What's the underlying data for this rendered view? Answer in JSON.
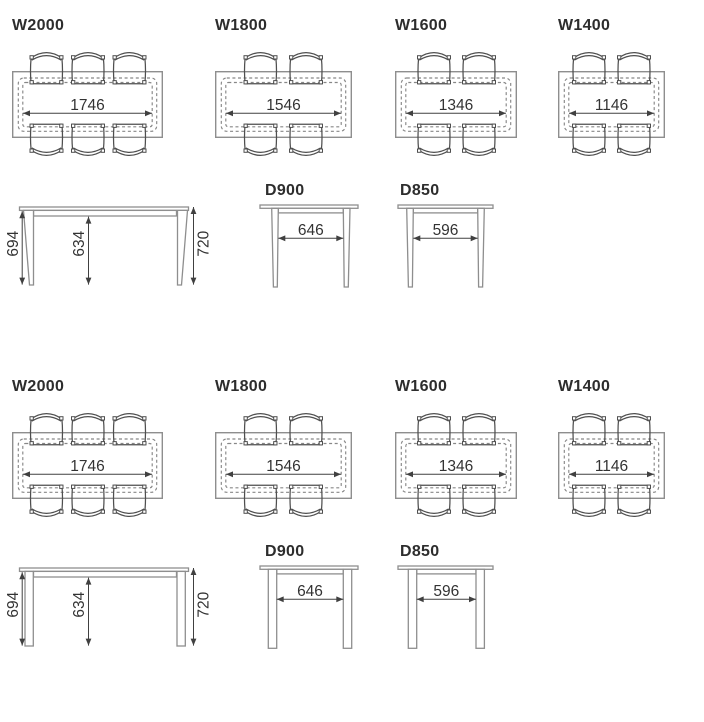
{
  "sections": [
    {
      "leg_style": "tapered",
      "top_views": [
        {
          "label": "W2000",
          "dim": "1746"
        },
        {
          "label": "W1800",
          "dim": "1546"
        },
        {
          "label": "W1600",
          "dim": "1346"
        },
        {
          "label": "W1400",
          "dim": "1146"
        }
      ],
      "side_view": {
        "left": "694",
        "middle": "634",
        "right": "720"
      },
      "end_views": [
        {
          "label": "D900",
          "dim": "646"
        },
        {
          "label": "D850",
          "dim": "596"
        }
      ]
    },
    {
      "leg_style": "straight",
      "top_views": [
        {
          "label": "W2000",
          "dim": "1746"
        },
        {
          "label": "W1800",
          "dim": "1546"
        },
        {
          "label": "W1600",
          "dim": "1346"
        },
        {
          "label": "W1400",
          "dim": "1146"
        }
      ],
      "side_view": {
        "left": "694",
        "middle": "634",
        "right": "720"
      },
      "end_views": [
        {
          "label": "D900",
          "dim": "646"
        },
        {
          "label": "D850",
          "dim": "596"
        }
      ]
    }
  ]
}
